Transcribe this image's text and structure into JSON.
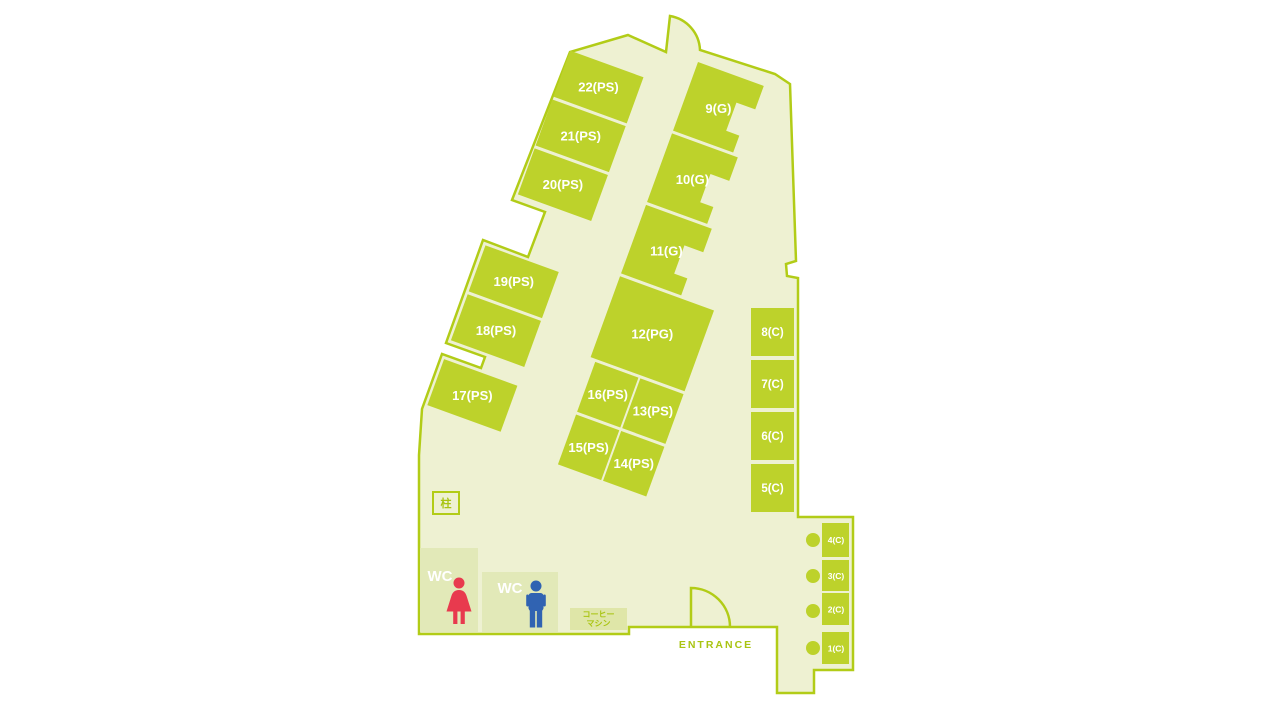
{
  "floor_map": {
    "title": "office floor map",
    "rooms": [
      {
        "id": "22",
        "label": "22(PS)"
      },
      {
        "id": "21",
        "label": "21(PS)"
      },
      {
        "id": "20",
        "label": "20(PS)"
      },
      {
        "id": "19",
        "label": "19(PS)"
      },
      {
        "id": "18",
        "label": "18(PS)"
      },
      {
        "id": "17",
        "label": "17(PS)"
      },
      {
        "id": "9",
        "label": "9(G)"
      },
      {
        "id": "10",
        "label": "10(G)"
      },
      {
        "id": "11",
        "label": "11(G)"
      },
      {
        "id": "12",
        "label": "12(PG)"
      },
      {
        "id": "16",
        "label": "16(PS)"
      },
      {
        "id": "13",
        "label": "13(PS)"
      },
      {
        "id": "15",
        "label": "15(PS)"
      },
      {
        "id": "14",
        "label": "14(PS)"
      },
      {
        "id": "8",
        "label": "8(C)"
      },
      {
        "id": "7",
        "label": "7(C)"
      },
      {
        "id": "6",
        "label": "6(C)"
      },
      {
        "id": "5",
        "label": "5(C)"
      },
      {
        "id": "4",
        "label": "4(C)"
      },
      {
        "id": "3",
        "label": "3(C)"
      },
      {
        "id": "2",
        "label": "2(C)"
      },
      {
        "id": "1",
        "label": "1(C)"
      }
    ],
    "labels": {
      "pillar": "柱",
      "wc_women": "WC",
      "wc_men": "WC",
      "coffee_line1": "コーヒー",
      "coffee_line2": "マシン",
      "entrance": "ENTRANCE"
    },
    "colors": {
      "room_fill": "#bdd22b",
      "outline_stroke": "#b2cc17",
      "floor_fill": "#eef1d2",
      "wc_fill": "#e2e9b8",
      "coffee_fill": "#dfe6a8",
      "female_icon": "#e83a4e",
      "male_icon": "#3063b2",
      "room_label_text": "#ffffff",
      "accent_text": "#a9c412"
    }
  }
}
